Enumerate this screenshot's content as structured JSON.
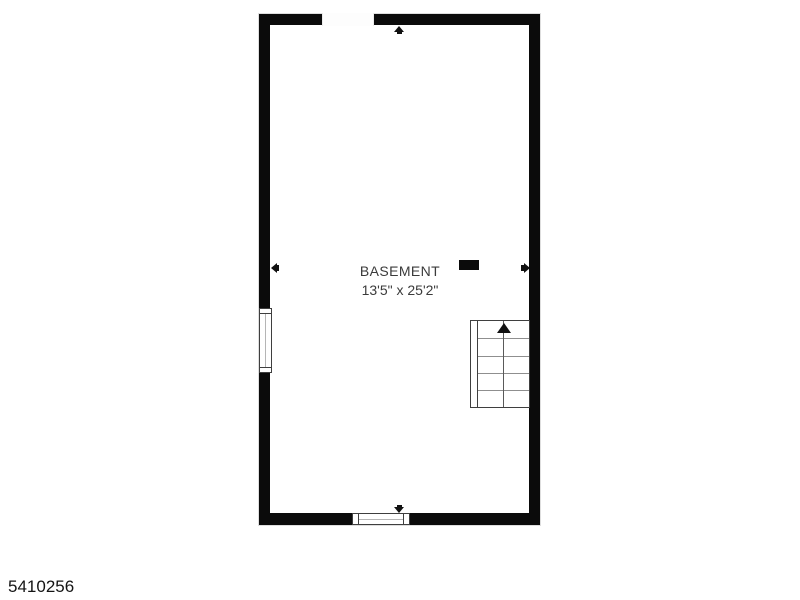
{
  "room": {
    "name": "BASEMENT",
    "dimensions": "13'5\" x 25'2\""
  },
  "footer": {
    "listing_id": "5410256"
  },
  "icons": {
    "dimension_arrow_up": "triangle-up",
    "dimension_arrow_down": "triangle-down",
    "dimension_arrow_left": "triangle-left",
    "dimension_arrow_right": "triangle-right",
    "stair_direction": "triangle-up"
  },
  "colors": {
    "wall": "#0b0b0b",
    "background": "#ffffff",
    "label_text": "#3b3b3b",
    "symbol_outline": "#3f3f3f",
    "stair_tread": "#8f8f8f"
  }
}
